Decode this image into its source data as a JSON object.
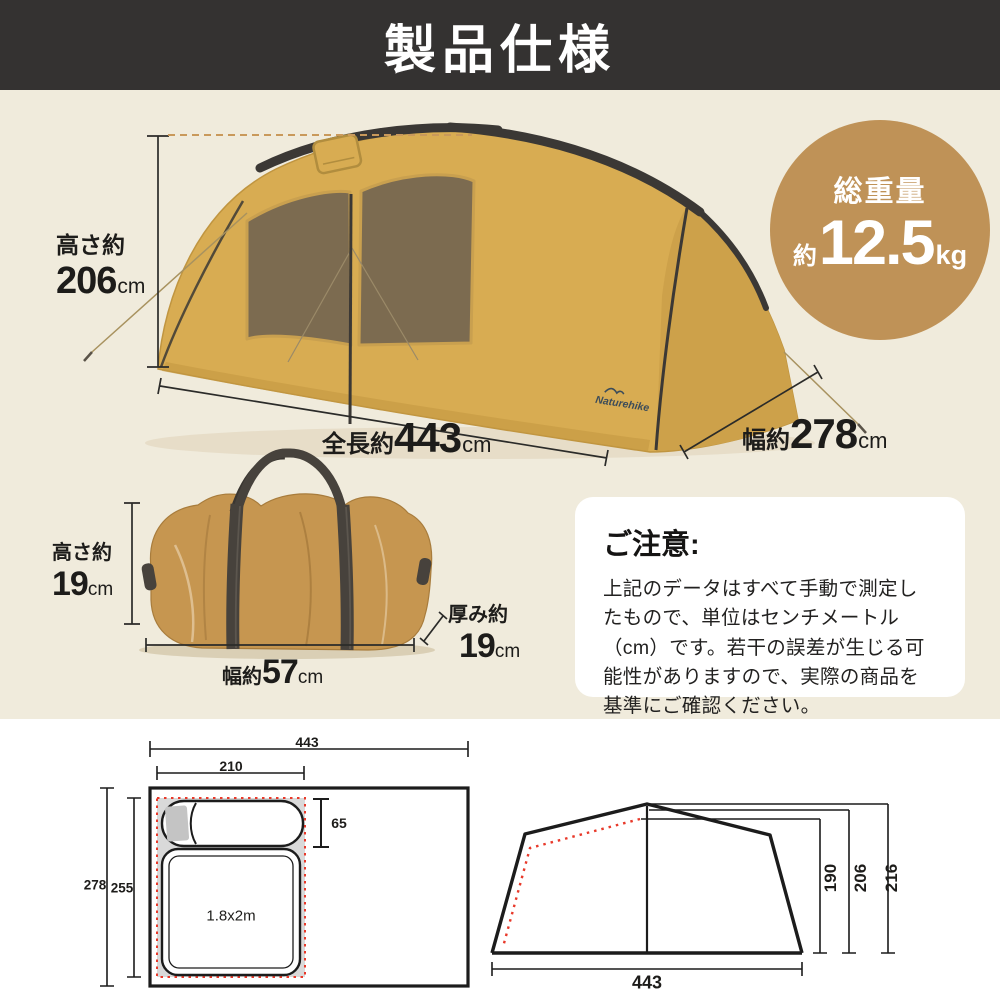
{
  "header": {
    "title": "製品仕様"
  },
  "tent": {
    "brand": "Naturehike",
    "height": {
      "prefix": "高さ約",
      "value": "206",
      "unit": "cm"
    },
    "length": {
      "prefix": "全長約",
      "value": "443",
      "unit": "cm"
    },
    "width": {
      "prefix": "幅約",
      "value": "278",
      "unit": "cm"
    },
    "weight": {
      "title": "総重量",
      "approx": "約",
      "value": "12.5",
      "unit": "kg"
    }
  },
  "bag": {
    "height": {
      "prefix": "高さ約",
      "value": "19",
      "unit": "cm"
    },
    "width": {
      "prefix": "幅約",
      "value": "57",
      "unit": "cm"
    },
    "depth": {
      "prefix": "厚み約",
      "value": "19",
      "unit": "cm"
    }
  },
  "notice": {
    "title": "ご注意:",
    "body": "上記のデータはすべて手動で測定したもので、単位はセンチメートル（cm）です。若干の誤差が生じる可能性がありますので、実際の商品を基準にご確認ください。"
  },
  "floor_plan": {
    "overall_width": "443",
    "inner_width": "210",
    "overall_depth": "278",
    "inner_depth": "255",
    "sleeping_width": "65",
    "mattress_size": "1.8x2m"
  },
  "elevation": {
    "base_width": "443",
    "inner_height": "190",
    "ridge_height": "206",
    "total_height": "216"
  }
}
